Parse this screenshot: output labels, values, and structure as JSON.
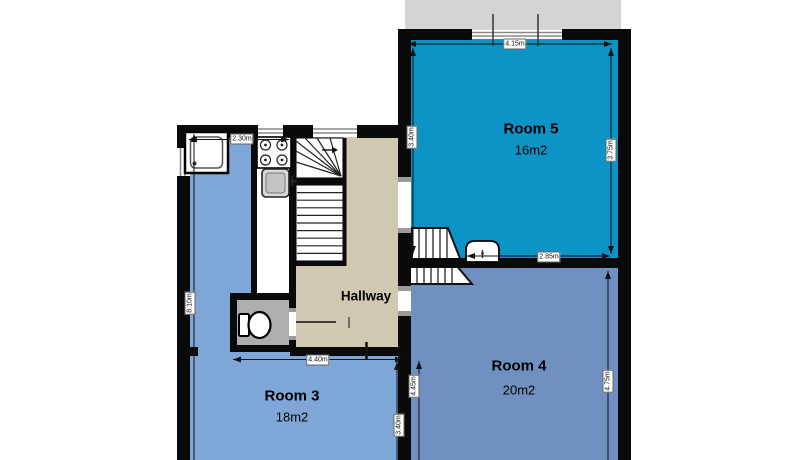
{
  "rooms": {
    "room5": {
      "label": "Room 5",
      "area": "16m2"
    },
    "room4": {
      "label": "Room 4",
      "area": "20m2"
    },
    "room3": {
      "label": "Room 3",
      "area": "18m2"
    },
    "hallway": {
      "label": "Hallway"
    }
  },
  "dimensions": {
    "room5_width": "4.15m",
    "room5_left_height": "3.40m",
    "room5_right_height": "3.75m",
    "room5_bottom_width": "2.85m",
    "entry_width": "2.30m",
    "room3_height": "8.10m",
    "hallway_width": "4.40m",
    "room3_lower_height": "3.40m",
    "room4_left_height": "4.45m",
    "room4_right_height": "4.75m"
  },
  "colors": {
    "room5": "#0d94c7",
    "room4": "#7190c2",
    "room3": "#7ea6d6",
    "hallway": "#cfc9b1",
    "wc": "#aeaeae",
    "outside": "#d4d4d4",
    "wall": "#0a0a0a"
  },
  "fixtures": {
    "shower": "shower",
    "stove": "stove",
    "kitchen_sink": "kitchen-sink",
    "toilet": "toilet",
    "basin": "basin",
    "main_staircase": "main-staircase",
    "room4_staircase": "room4-staircase"
  }
}
